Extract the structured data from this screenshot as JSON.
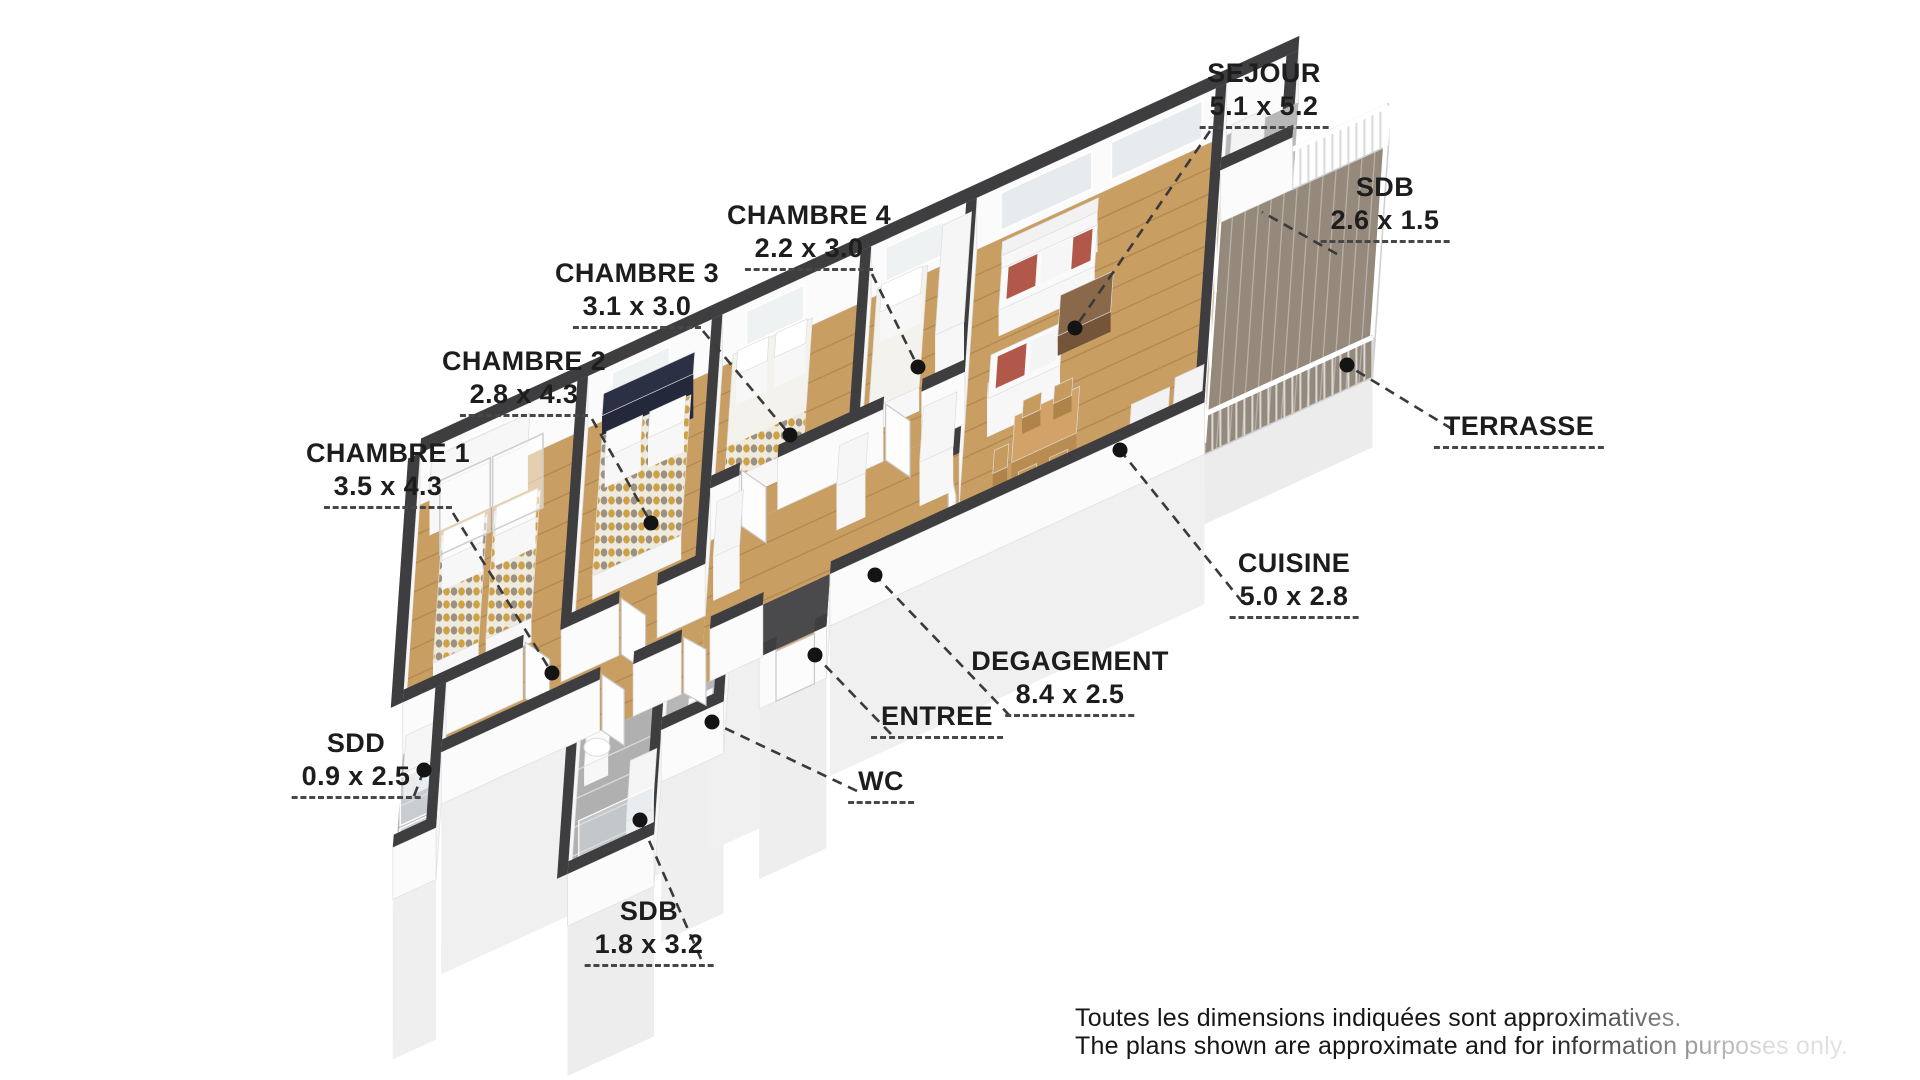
{
  "rooms": [
    {
      "id": "sejour",
      "name": "SEJOUR",
      "dims": "5.1 x 5.2"
    },
    {
      "id": "sdb-top",
      "name": "SDB",
      "dims": "2.6 x 1.5"
    },
    {
      "id": "terrasse",
      "name": "TERRASSE",
      "dims": ""
    },
    {
      "id": "cuisine",
      "name": "CUISINE",
      "dims": "5.0 x 2.8"
    },
    {
      "id": "degagement",
      "name": "DEGAGEMENT",
      "dims": "8.4 x 2.5"
    },
    {
      "id": "entree",
      "name": "ENTREE",
      "dims": ""
    },
    {
      "id": "wc",
      "name": "WC",
      "dims": ""
    },
    {
      "id": "sdb-bottom",
      "name": "SDB",
      "dims": "1.8 x 3.2"
    },
    {
      "id": "sdd",
      "name": "SDD",
      "dims": "0.9 x 2.5"
    },
    {
      "id": "chambre1",
      "name": "CHAMBRE 1",
      "dims": "3.5 x 4.3"
    },
    {
      "id": "chambre2",
      "name": "CHAMBRE 2",
      "dims": "2.8 x 4.3"
    },
    {
      "id": "chambre3",
      "name": "CHAMBRE 3",
      "dims": "3.1 x 3.0"
    },
    {
      "id": "chambre4",
      "name": "CHAMBRE 4",
      "dims": "2.2 x 3.0"
    }
  ],
  "disclaimer": {
    "line1": "Toutes les dimensions indiquées sont approximatives.",
    "line2": "The plans shown are approximate and for information purposes only."
  },
  "colors": {
    "wood_floor": "#c99e63",
    "terrace_deck": "#95897c",
    "tile_floor": "#b7b7b7",
    "wall_cap": "#3e3e41",
    "label_text": "#1d1d1d",
    "accent_cushion": "#b2584a"
  }
}
